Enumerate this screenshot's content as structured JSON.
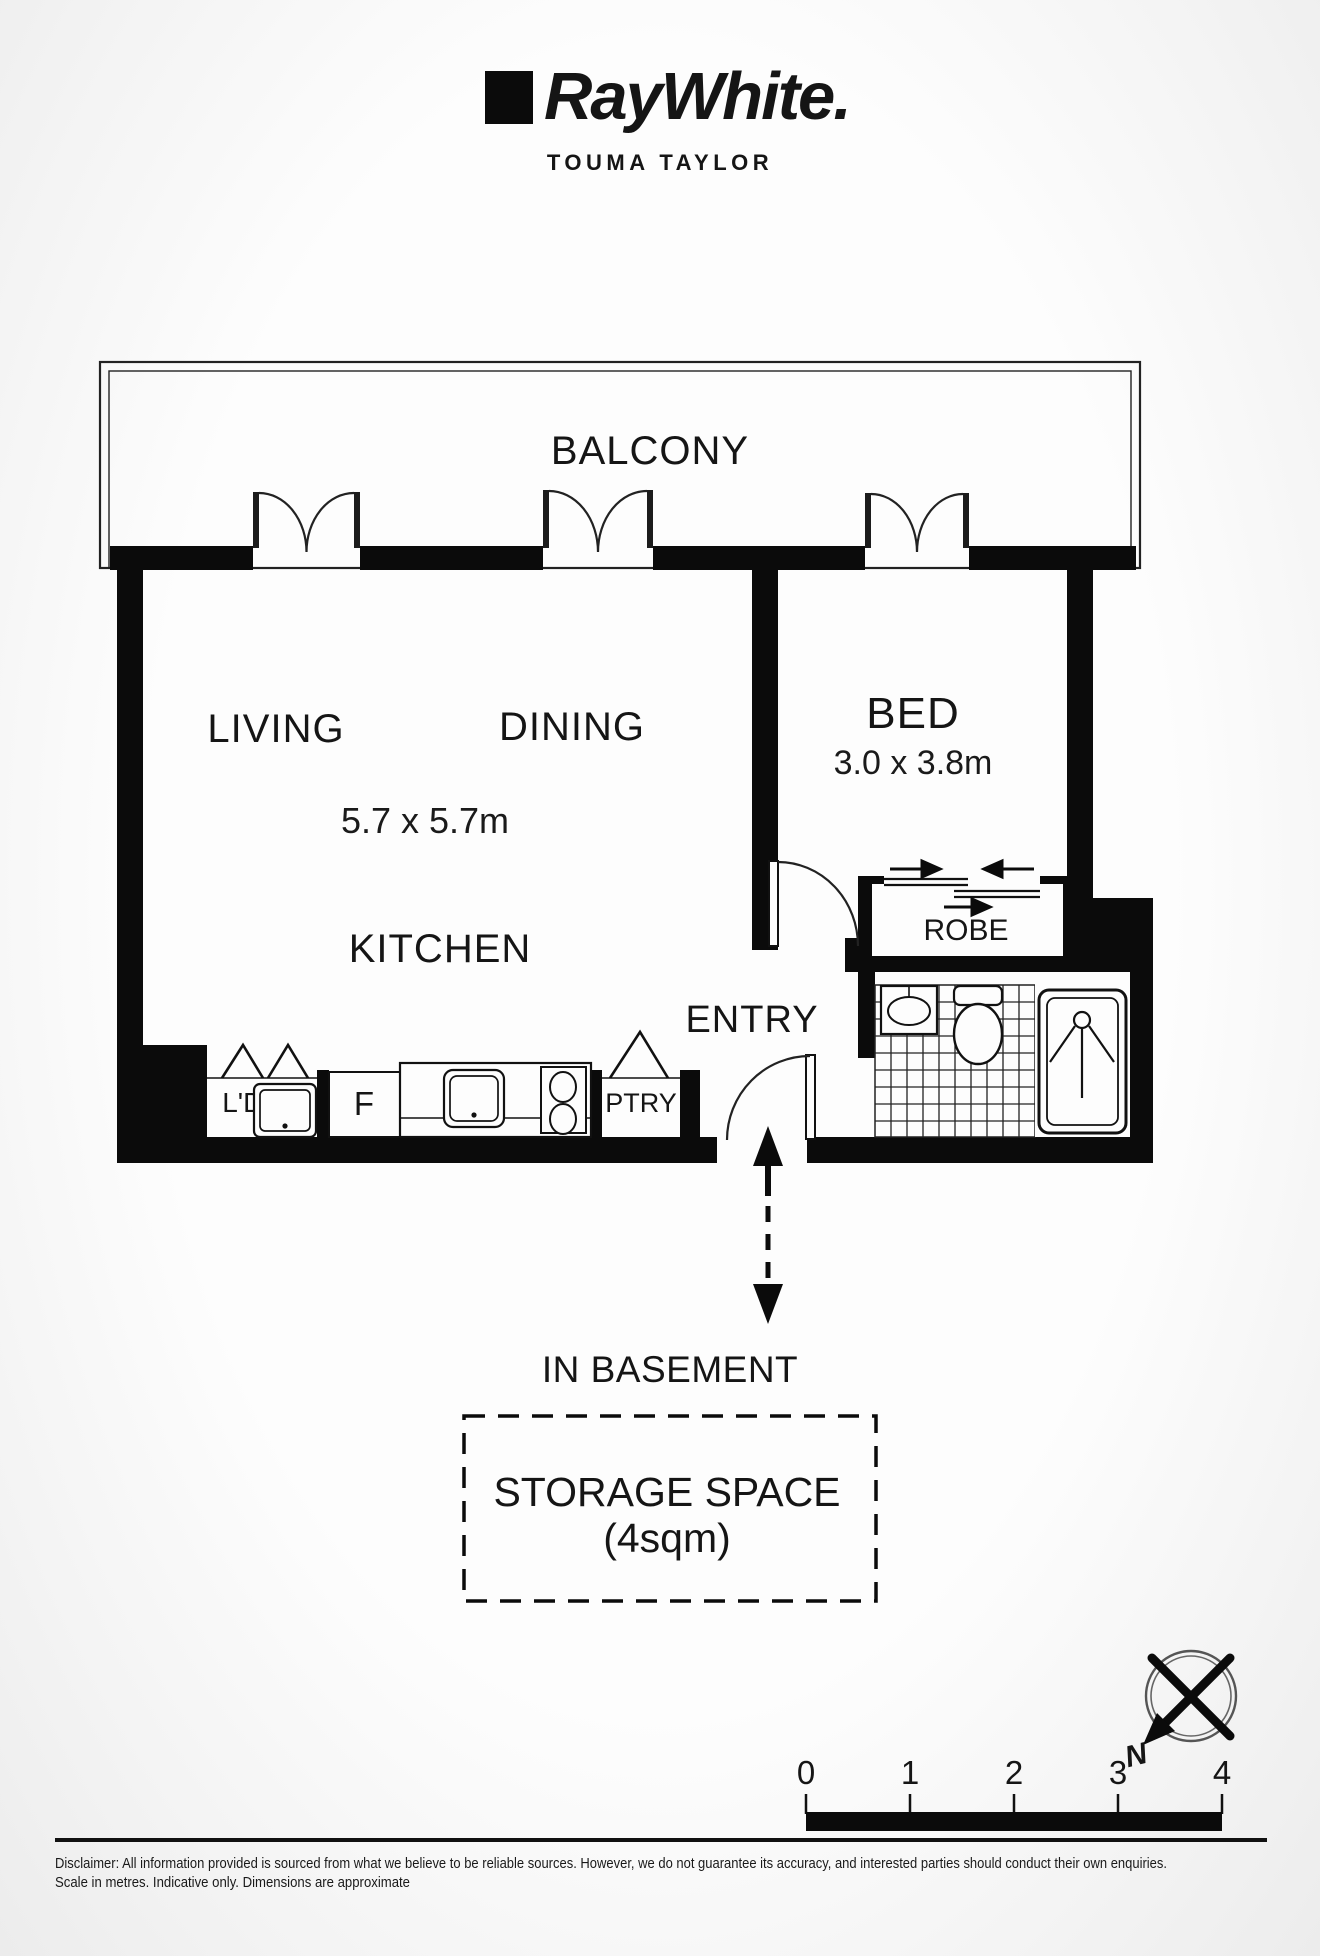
{
  "header": {
    "brand": "RayWhite.",
    "office": "TOUMA TAYLOR"
  },
  "rooms": {
    "balcony": "BALCONY",
    "living": "LIVING",
    "dining": "DINING",
    "living_dims": "5.7 x 5.7m",
    "kitchen": "KITCHEN",
    "bed": "BED",
    "bed_dims": "3.0 x 3.8m",
    "entry": "ENTRY",
    "robe": "ROBE",
    "laundry": "L'DRY",
    "fridge": "F",
    "pantry": "PTRY"
  },
  "basement": {
    "note": "IN BASEMENT",
    "storage_title": "STORAGE SPACE",
    "storage_size": "(4sqm)"
  },
  "compass": {
    "north": "N"
  },
  "scale_bar": {
    "labels": [
      "0",
      "1",
      "2",
      "3",
      "4"
    ]
  },
  "footer": {
    "disclaimer": "Disclaimer: All information provided is sourced from what we believe to be reliable sources. However, we do not guarantee  its accuracy, and interested parties should conduct their own enquiries.",
    "scale_note": "Scale in metres. Indicative only. Dimensions are approximate"
  },
  "colors": {
    "wall": "#0b0b0b",
    "line": "#222222",
    "label": "#151515",
    "paper_center": "#fdfdfd",
    "paper_edge": "#ececec"
  }
}
